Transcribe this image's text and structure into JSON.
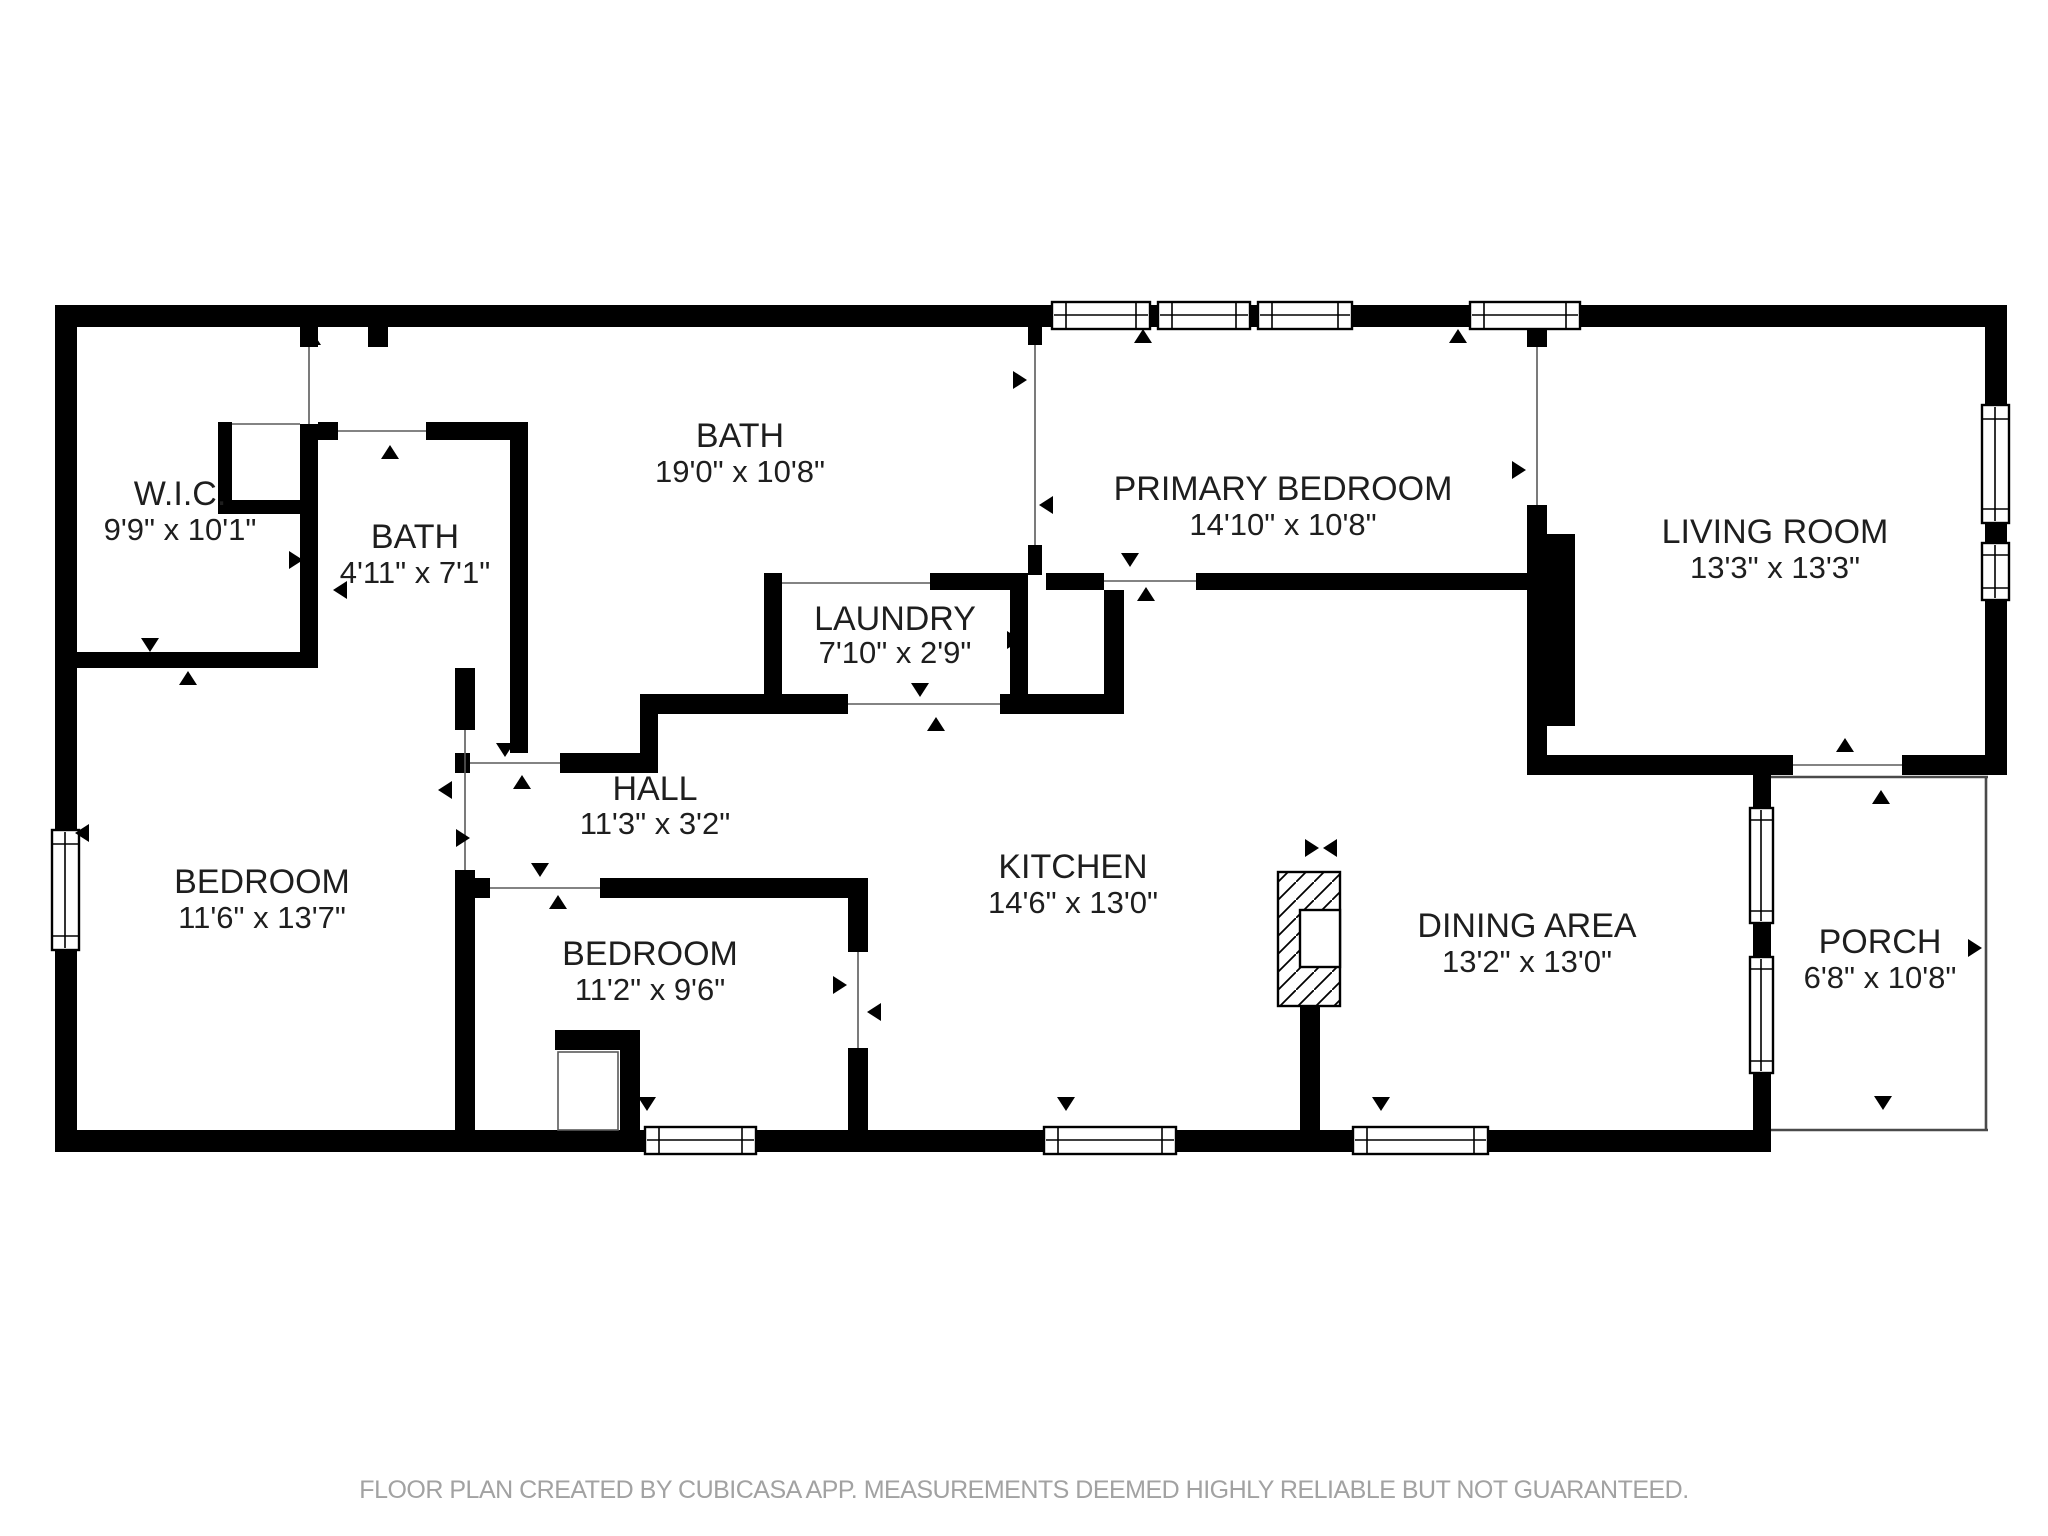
{
  "footer": {
    "text": "FLOOR PLAN CREATED BY CUBICASA APP. MEASUREMENTS DEEMED HIGHLY RELIABLE BUT NOT GUARANTEED."
  },
  "rooms": [
    {
      "id": "wic",
      "name": "W.I.C.",
      "dims": "9'9\" x 10'1\""
    },
    {
      "id": "bath-small",
      "name": "BATH",
      "dims": "4'11\" x 7'1\""
    },
    {
      "id": "bath-large",
      "name": "BATH",
      "dims": "19'0\" x 10'8\""
    },
    {
      "id": "laundry",
      "name": "LAUNDRY",
      "dims": "7'10\" x 2'9\""
    },
    {
      "id": "hall",
      "name": "HALL",
      "dims": "11'3\" x 3'2\""
    },
    {
      "id": "primary-bedroom",
      "name": "PRIMARY BEDROOM",
      "dims": "14'10\" x 10'8\""
    },
    {
      "id": "living-room",
      "name": "LIVING ROOM",
      "dims": "13'3\" x 13'3\""
    },
    {
      "id": "bedroom-left",
      "name": "BEDROOM",
      "dims": "11'6\" x 13'7\""
    },
    {
      "id": "bedroom-middle",
      "name": "BEDROOM",
      "dims": "11'2\" x 9'6\""
    },
    {
      "id": "kitchen",
      "name": "KITCHEN",
      "dims": "14'6\" x 13'0\""
    },
    {
      "id": "dining-area",
      "name": "DINING AREA",
      "dims": "13'2\" x 13'0\""
    },
    {
      "id": "porch",
      "name": "PORCH",
      "dims": "6'8\" x 10'8\""
    }
  ],
  "colors": {
    "wall": "#000000",
    "floor": "#ffffff",
    "footer_text": "#a2a2a2",
    "window_frame": "#000000"
  },
  "icons": {
    "door_arrow": "small filled triangle door/window marker",
    "opening_marker": "bowtie facing-triangles opening marker",
    "kitchen_island": "diagonal-hatched fixture with white inset"
  }
}
